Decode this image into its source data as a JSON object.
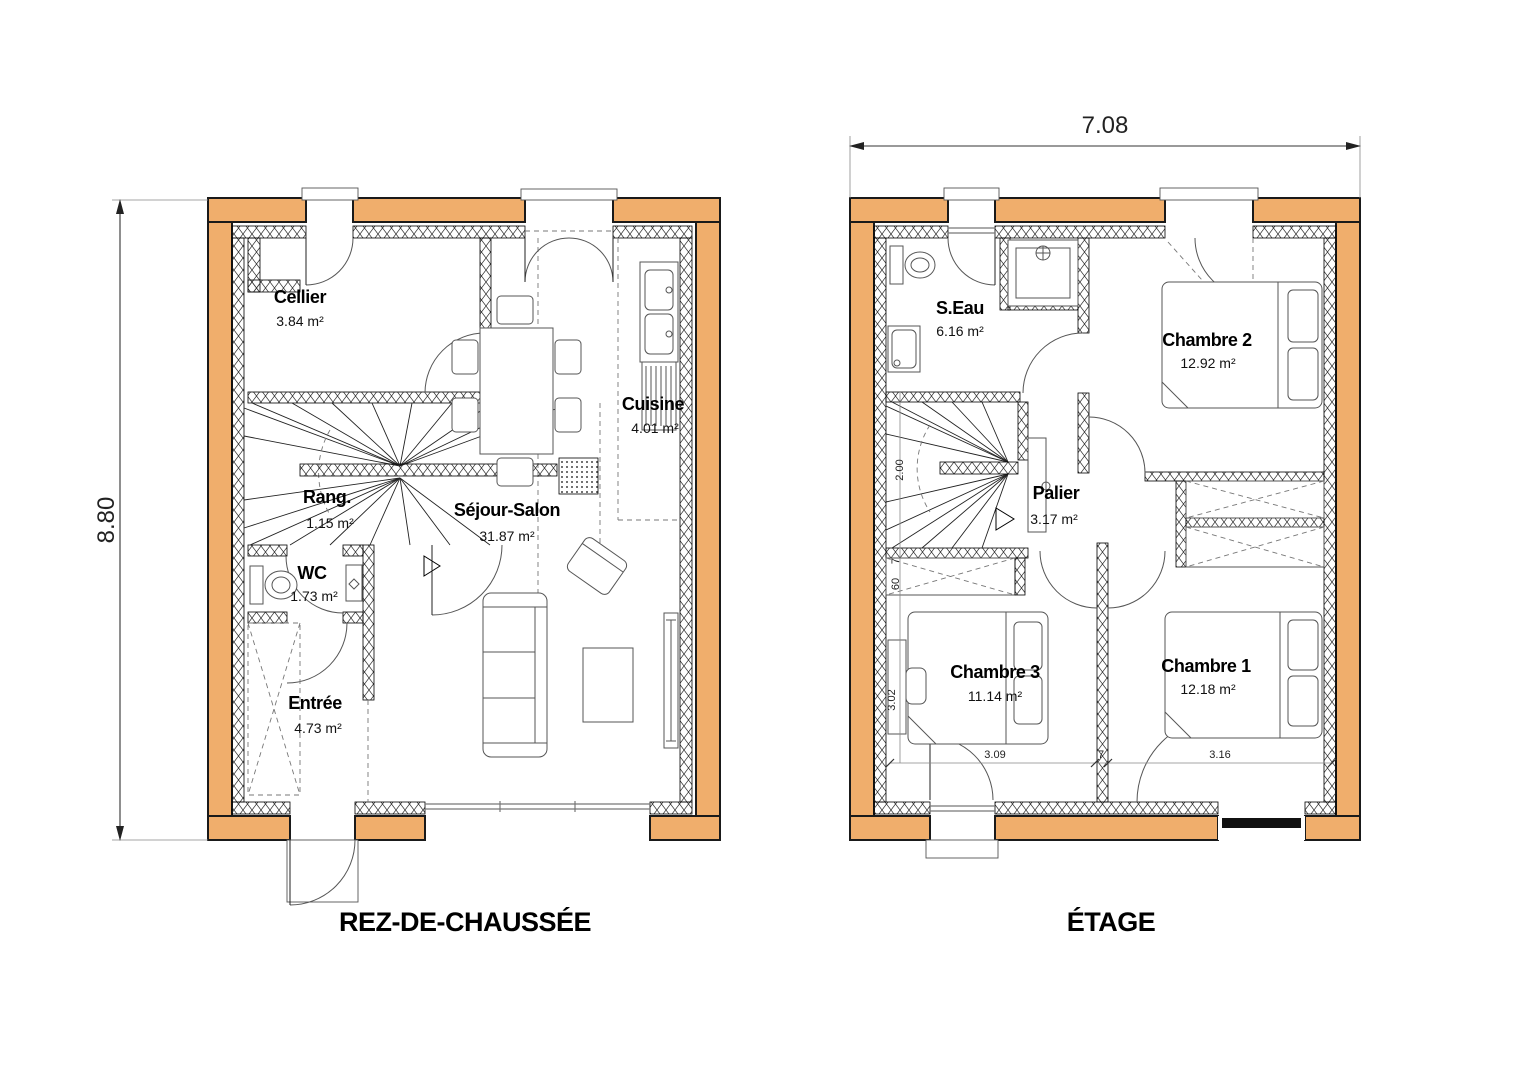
{
  "colors": {
    "wall_fill": "#F0AE6C",
    "line": "#000000"
  },
  "overall_dimensions": {
    "width": "7.08",
    "height": "8.80"
  },
  "ground_floor": {
    "title": "REZ-DE-CHAUSSÉE",
    "rooms": [
      {
        "name": "Cellier",
        "area": "3.84 m²"
      },
      {
        "name": "Cuisine",
        "area": "4.01 m²"
      },
      {
        "name": "Séjour-Salon",
        "area": "31.87 m²"
      },
      {
        "name": "Rang.",
        "area": "1.15 m²"
      },
      {
        "name": "WC",
        "area": "1.73 m²"
      },
      {
        "name": "Entrée",
        "area": "4.73 m²"
      }
    ]
  },
  "upper_floor": {
    "title": "ÉTAGE",
    "rooms": [
      {
        "name": "S.Eau",
        "area": "6.16 m²"
      },
      {
        "name": "Chambre 2",
        "area": "12.92 m²"
      },
      {
        "name": "Palier",
        "area": "3.17 m²"
      },
      {
        "name": "Chambre 3",
        "area": "11.14 m²"
      },
      {
        "name": "Chambre 1",
        "area": "12.18 m²"
      }
    ],
    "inner_dimensions": {
      "stair_width": "2.00",
      "closet_a": "60",
      "closet_b": "7",
      "left_height": "3.02",
      "bottom_left": "3.09",
      "bottom_mid": "7",
      "bottom_right": "3.16"
    }
  }
}
